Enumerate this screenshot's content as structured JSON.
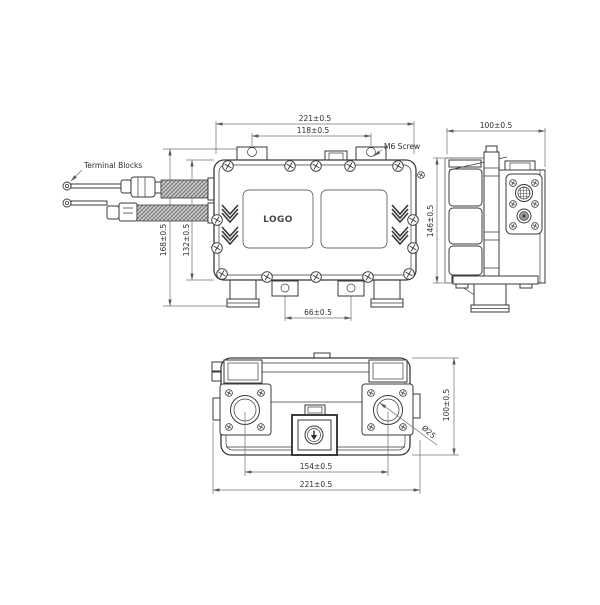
{
  "drawing": {
    "front": {
      "labels": {
        "terminal_blocks": "Terminal Blocks",
        "m6_screw": "M6 Screw",
        "logo": "LOGO"
      },
      "dims": {
        "overall_width": "221±0.5",
        "mount_hole_spacing": "118±0.5",
        "overall_height": "168±0.5",
        "body_height": "132±0.5",
        "bottom_tab_spacing": "66±0.5"
      }
    },
    "side": {
      "dims": {
        "width": "100±0.5",
        "height": "146±0.5"
      }
    },
    "bottom": {
      "labels": {
        "port_diameter": "Ø25"
      },
      "dims": {
        "port_center_spacing": "154±0.5",
        "overall_width": "221±0.5",
        "depth": "100±0.5"
      }
    },
    "colors": {
      "line": "#3a3a3a",
      "dimension": "#707070",
      "background": "#ffffff"
    }
  }
}
